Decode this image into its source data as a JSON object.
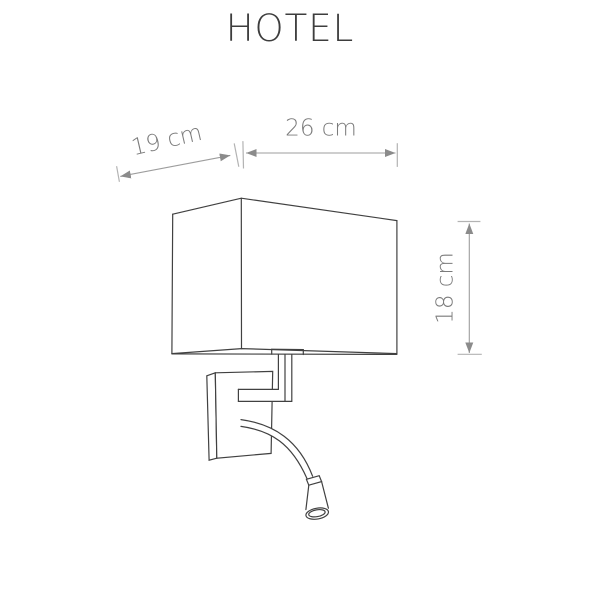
{
  "title": "HOTEL",
  "dimensions": {
    "depth": "19 cm",
    "width": "26 cm",
    "height": "18 cm"
  },
  "figure": {
    "description": "Technical line drawing of the HOTEL wall lamp: rectangular box lampshade on a wall-mount bracket with an L-shaped arm and a flexible gooseneck reading light with conical LED head",
    "shade_width": "26 cm",
    "shade_depth": "19 cm",
    "shade_height": "18 cm"
  },
  "colors": {
    "background": "#ffffff",
    "lamp_outline": "#414141",
    "dimension_line": "#9d9d9d",
    "dimension_arrow": "#8b8b8b",
    "extension_tick": "#b3b3b3",
    "dimension_text": "#7b7b7b",
    "title_text": "#3d3d3d"
  }
}
